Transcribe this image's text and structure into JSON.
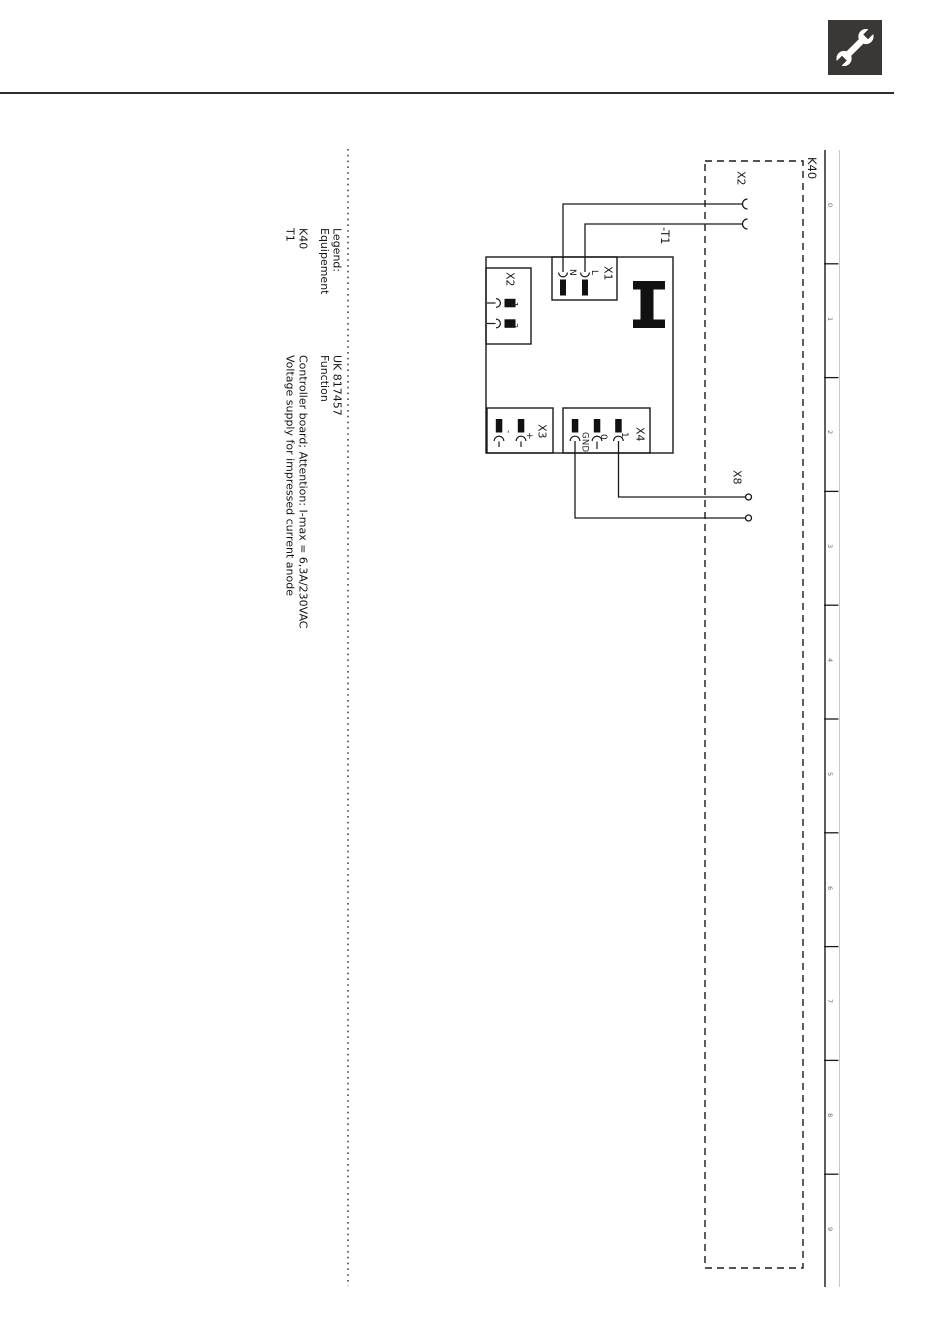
{
  "header": {
    "icon": "wrench-icon"
  },
  "legend": {
    "block1": [
      "Legend:",
      "Equipement",
      "K40",
      "T1"
    ],
    "block2": [
      "UK 817457",
      "Function",
      "Controller board; Attention: I-max = 6,3A/230VAC",
      "Voltage supply for impressed current anode"
    ]
  },
  "diagram": {
    "module": "K40",
    "board": "-T1",
    "external": {
      "x2": "X2",
      "x8": "X8"
    },
    "x1": {
      "label": "X1",
      "pins": [
        "N",
        "L"
      ]
    },
    "x2": {
      "label": "X2",
      "pins": [
        "1",
        "2"
      ]
    },
    "x3": {
      "label": "X3",
      "pins": [
        "-",
        "+"
      ]
    },
    "x4": {
      "label": "X4",
      "pins": [
        "GND",
        "0",
        "1"
      ]
    }
  },
  "ruler": {
    "numbers": [
      "0",
      "1",
      "2",
      "3",
      "4",
      "5",
      "6",
      "7",
      "8",
      "9"
    ]
  },
  "colors": {
    "ink": "#1a1a1a",
    "icon_bg": "#3a3734",
    "ruler_digit": "#666666",
    "faint_line": "#c8c8c8"
  }
}
